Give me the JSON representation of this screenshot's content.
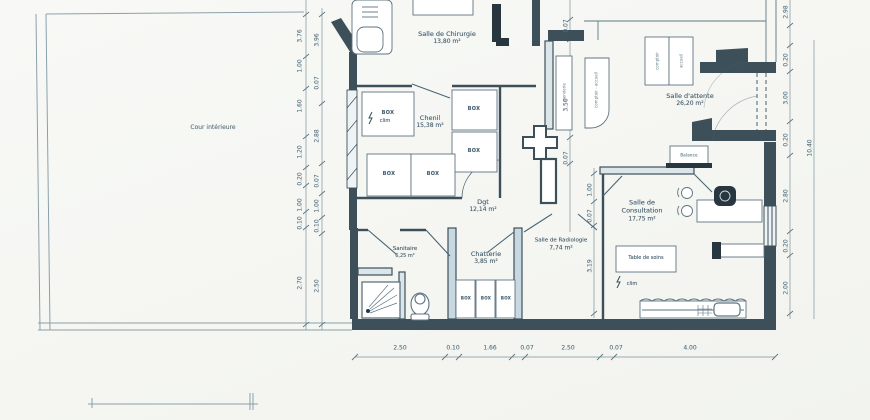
{
  "plan": {
    "courtyard_label": "Cour intérieure",
    "rooms": {
      "chirurgie": {
        "name": "Salle de Chirurgie",
        "area": "13,80 m²"
      },
      "chenil": {
        "name": "Chenil",
        "area": "15,38 m²"
      },
      "attente": {
        "name": "Salle d'attente",
        "area": "26,20 m²"
      },
      "consultation": {
        "name": "Salle de Consultation",
        "area": "17,75 m²"
      },
      "dgt": {
        "name": "Dgt",
        "area": "12,14 m²"
      },
      "chatterie": {
        "name": "Chatterie",
        "area": "3,85 m²"
      },
      "radiologie": {
        "name": "Salle de Radiologie",
        "area": "7,74 m²"
      },
      "sanitaire": {
        "name": "Sanitaire",
        "area": "6,25 m²"
      }
    },
    "labels": {
      "box": "BOX",
      "clim": "clim",
      "table_soins": "Table de soins",
      "balance": "Balance",
      "counter_a": "comptoir",
      "counter_b": "accueil",
      "cabinet_left": "penderie",
      "cabinet_right": "comptoir - accueil"
    },
    "dims": {
      "left_outer": [
        "3.76",
        "1.00",
        "1.60",
        "1.20",
        "0.20",
        "1.00",
        "0.10",
        "2.70"
      ],
      "left_inner": [
        "3.96",
        "0.07",
        "2.88",
        "0.07",
        "1.00",
        "0.10",
        "2.50"
      ],
      "middle_upper": [
        "0.07",
        "3.50",
        "0.07"
      ],
      "middle_lower": [
        "1.00",
        "0.07",
        "3.19"
      ],
      "right": [
        "2.98",
        "0.20",
        "3.00",
        "0.20",
        "2.80",
        "0.20",
        "2.00"
      ],
      "right_total": "10.40",
      "bottom": [
        "2.50",
        "0.10",
        "1.66",
        "0.07",
        "2.50",
        "0.07",
        "4.00"
      ]
    }
  }
}
